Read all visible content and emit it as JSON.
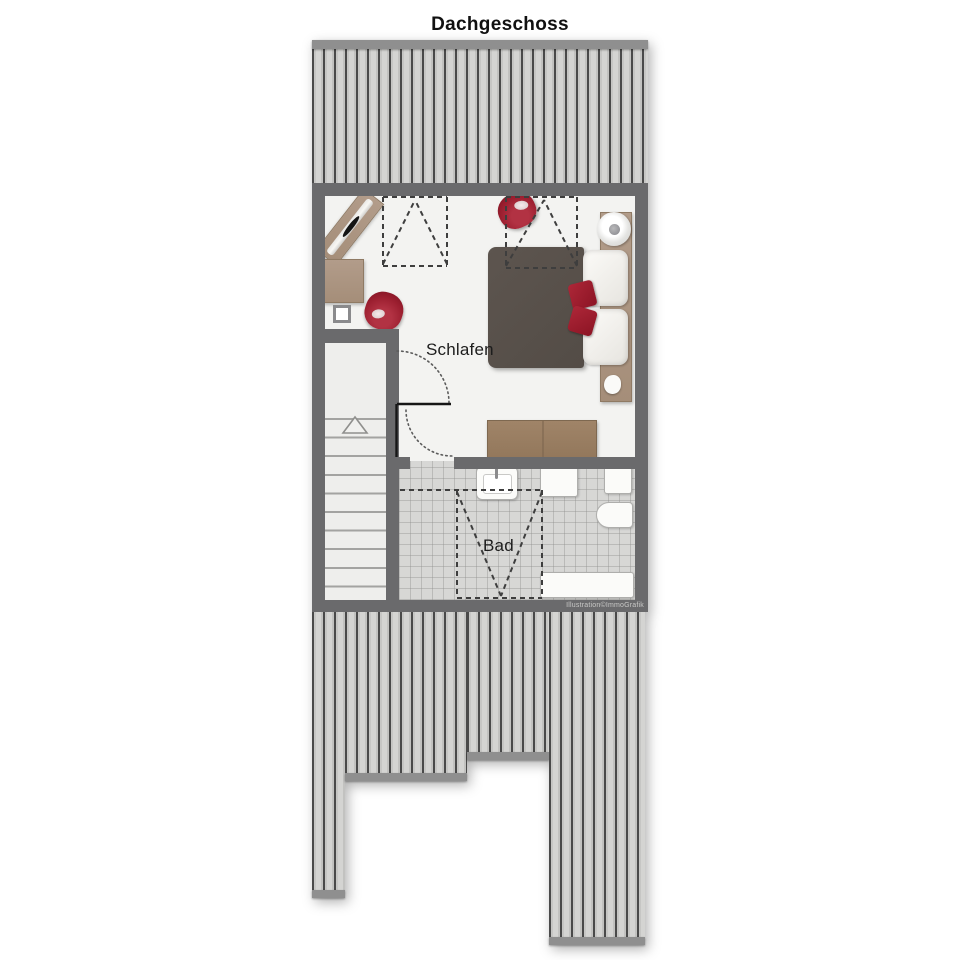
{
  "title": "Dachgeschoss",
  "watermark": "Illustration©ImmoGrafik",
  "rooms": {
    "bedroom": {
      "label": "Schlafen",
      "type": "bedroom",
      "furniture": [
        "angled-console",
        "side-table",
        "red-armchair",
        "red-pouf",
        "double-bed",
        "pillows",
        "red-cushions",
        "wall-shelf",
        "decor-bowl",
        "sideboard",
        "chimney-shaft"
      ]
    },
    "bathroom": {
      "label": "Bad",
      "type": "bathroom",
      "fixtures": [
        "sink",
        "cabinet",
        "shelf-box",
        "toilet",
        "bathtub"
      ]
    }
  },
  "features": {
    "staircase": "up",
    "door_swings": 2,
    "roof_slope_projections": 3,
    "roof_decking": [
      "top-full-width",
      "bottom-left-column",
      "bottom-left-mid",
      "bottom-mid",
      "bottom-right-column"
    ]
  },
  "colors": {
    "wall": "#6a6a6c",
    "floor": "#f3f3f1",
    "tile": "#d7d7d5",
    "roof_stripe_dark": "#4a4a4a",
    "roof_stripe_light": "#d4d4d2",
    "roof_edge_bar": "#8f8f8f",
    "wood": "#ab9581",
    "wood_dark": "#9b8164",
    "bed_duvet": "#57504a",
    "accent_red": "#9c1f30",
    "fixture_white": "#fbfbf9"
  }
}
